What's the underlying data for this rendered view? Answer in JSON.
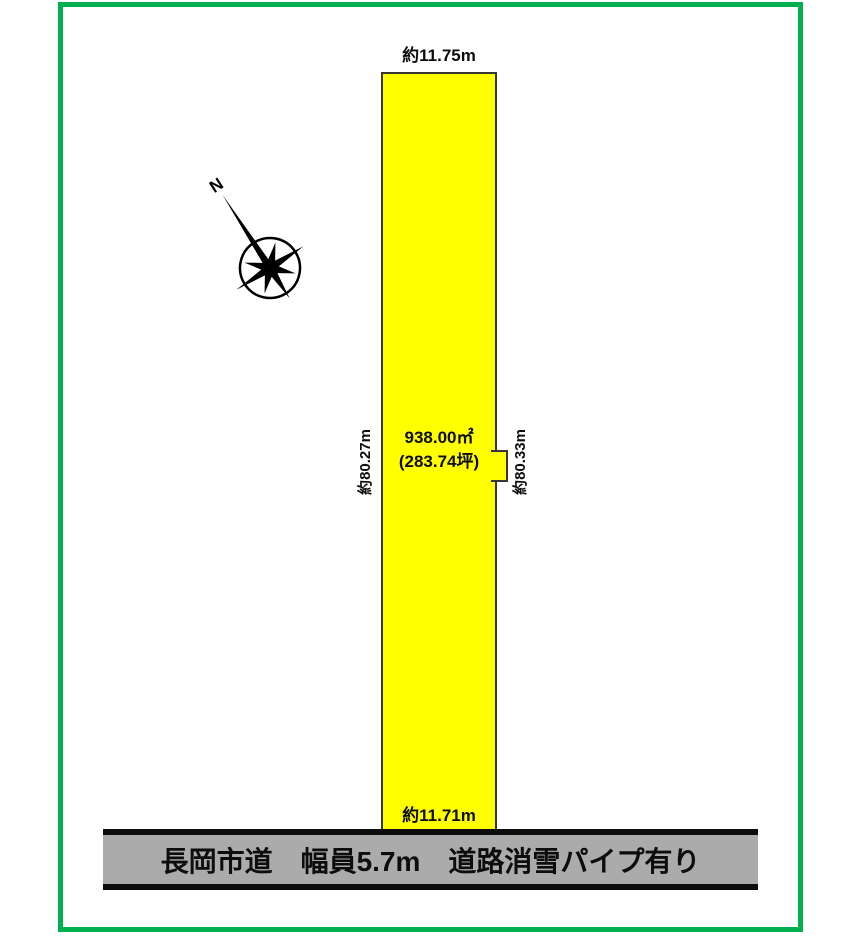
{
  "frame": {
    "border_color": "#00B050"
  },
  "compass": {
    "north_label": "N"
  },
  "parcel": {
    "fill_color": "#FFFF00",
    "top_width": "約11.75m",
    "bottom_width": "約11.71m",
    "left_length": "約80.27m",
    "right_length": "約80.33m",
    "area_sqm": "938.00㎡",
    "area_tsubo": "(283.74坪)"
  },
  "road": {
    "fill_color": "#ABABAB",
    "label": "長岡市道　幅員5.7m　道路消雪パイプ有り"
  }
}
